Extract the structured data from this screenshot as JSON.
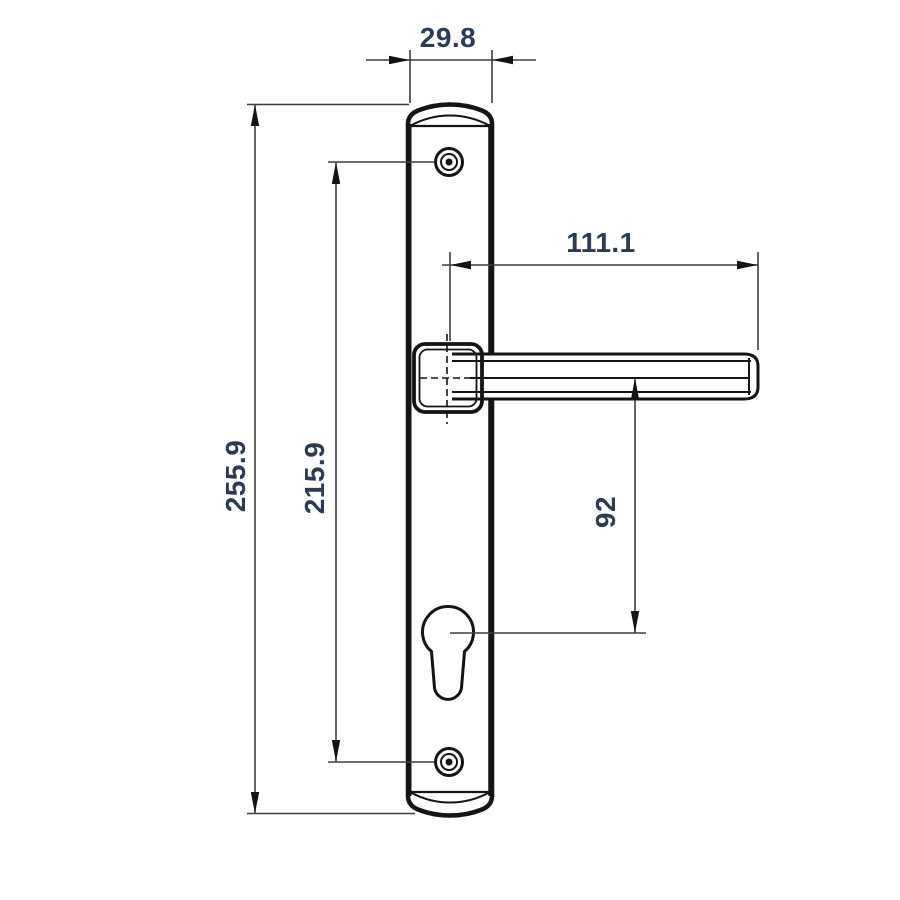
{
  "drawing": {
    "name": "Door handle with long backplate — dimensioned technical drawing",
    "view": "front view",
    "dimensions": {
      "plate_width": "29.8",
      "overall_height": "255.9",
      "fixing_hole_spacing": "215.9",
      "lever_length": "111.1",
      "lever_axis_to_cylinder": "92"
    },
    "colors": {
      "outline": "#141414",
      "dimension_line": "#3f3f3f",
      "dimension_text": "#2b3a55",
      "background": "#ffffff"
    }
  }
}
